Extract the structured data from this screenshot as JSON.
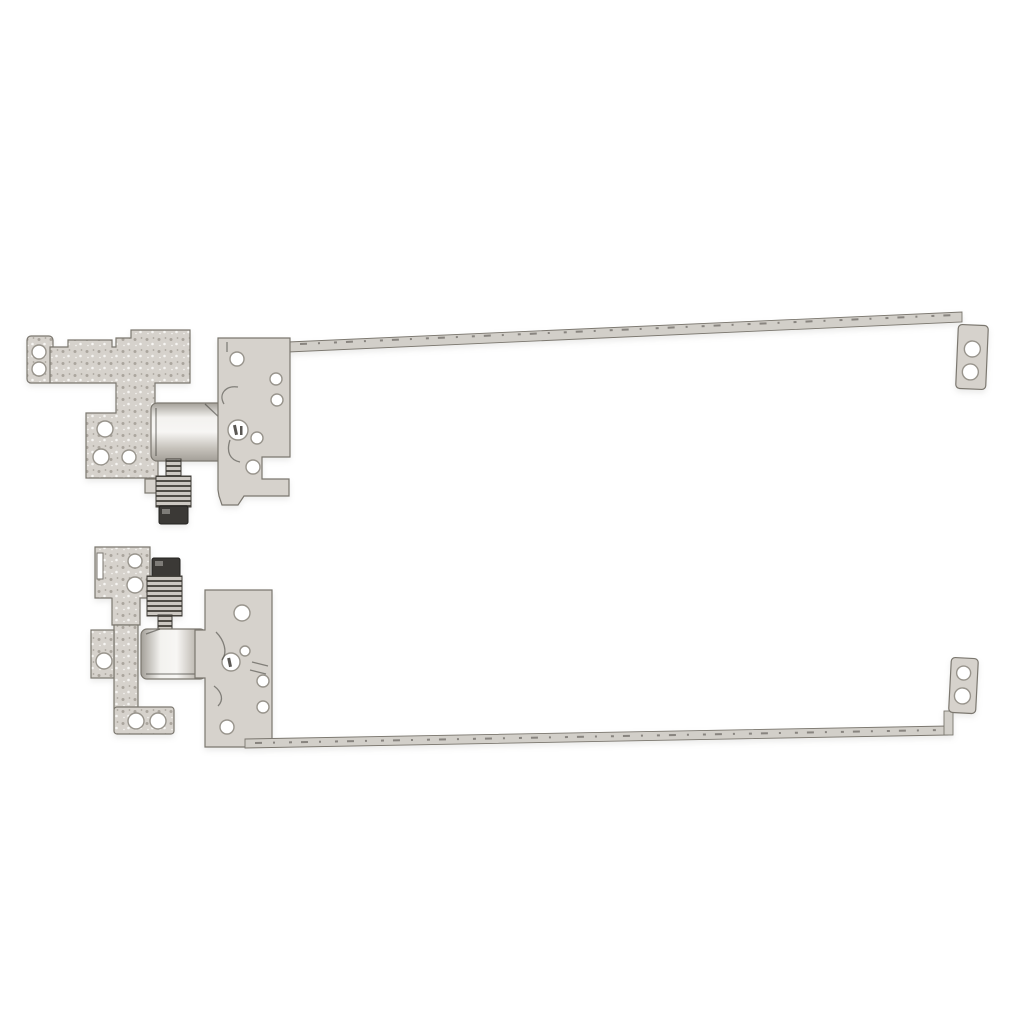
{
  "image": {
    "kind": "product-photo",
    "alt": "Pair of silver-tone laptop LCD screen hinge brackets with long support rails, left and right set, on a plain white background",
    "background": "#ffffff"
  },
  "colors": {
    "metal_base": "#d6d2cc",
    "metal_light": "#f3f2ef",
    "metal_mid": "#c6c2bb",
    "metal_shadow": "#a39f98",
    "dot_dark": "#aaa59d",
    "dot_light": "#f6f5f2",
    "outline": "#7b776f",
    "sketch": "#3d3a35",
    "hole_fill": "#ffffff",
    "hole_stroke": "#98948c",
    "rail_fill": "#d2cfc9",
    "thread_dark": "#504d47",
    "thread_light": "#ccc8c2",
    "nut_dark": "#3b3936",
    "nut_edge": "#232220",
    "nut_glint": "#7e7c78"
  },
  "parts": {
    "top_hinge": {
      "name": "left-hinge-rail-assembly",
      "screw_holes": 13,
      "has_threaded_axle": true,
      "rail_points_right": true
    },
    "bottom_hinge": {
      "name": "right-hinge-rail-assembly",
      "screw_holes": 13,
      "has_threaded_axle": true,
      "rail_points_right": true
    }
  }
}
